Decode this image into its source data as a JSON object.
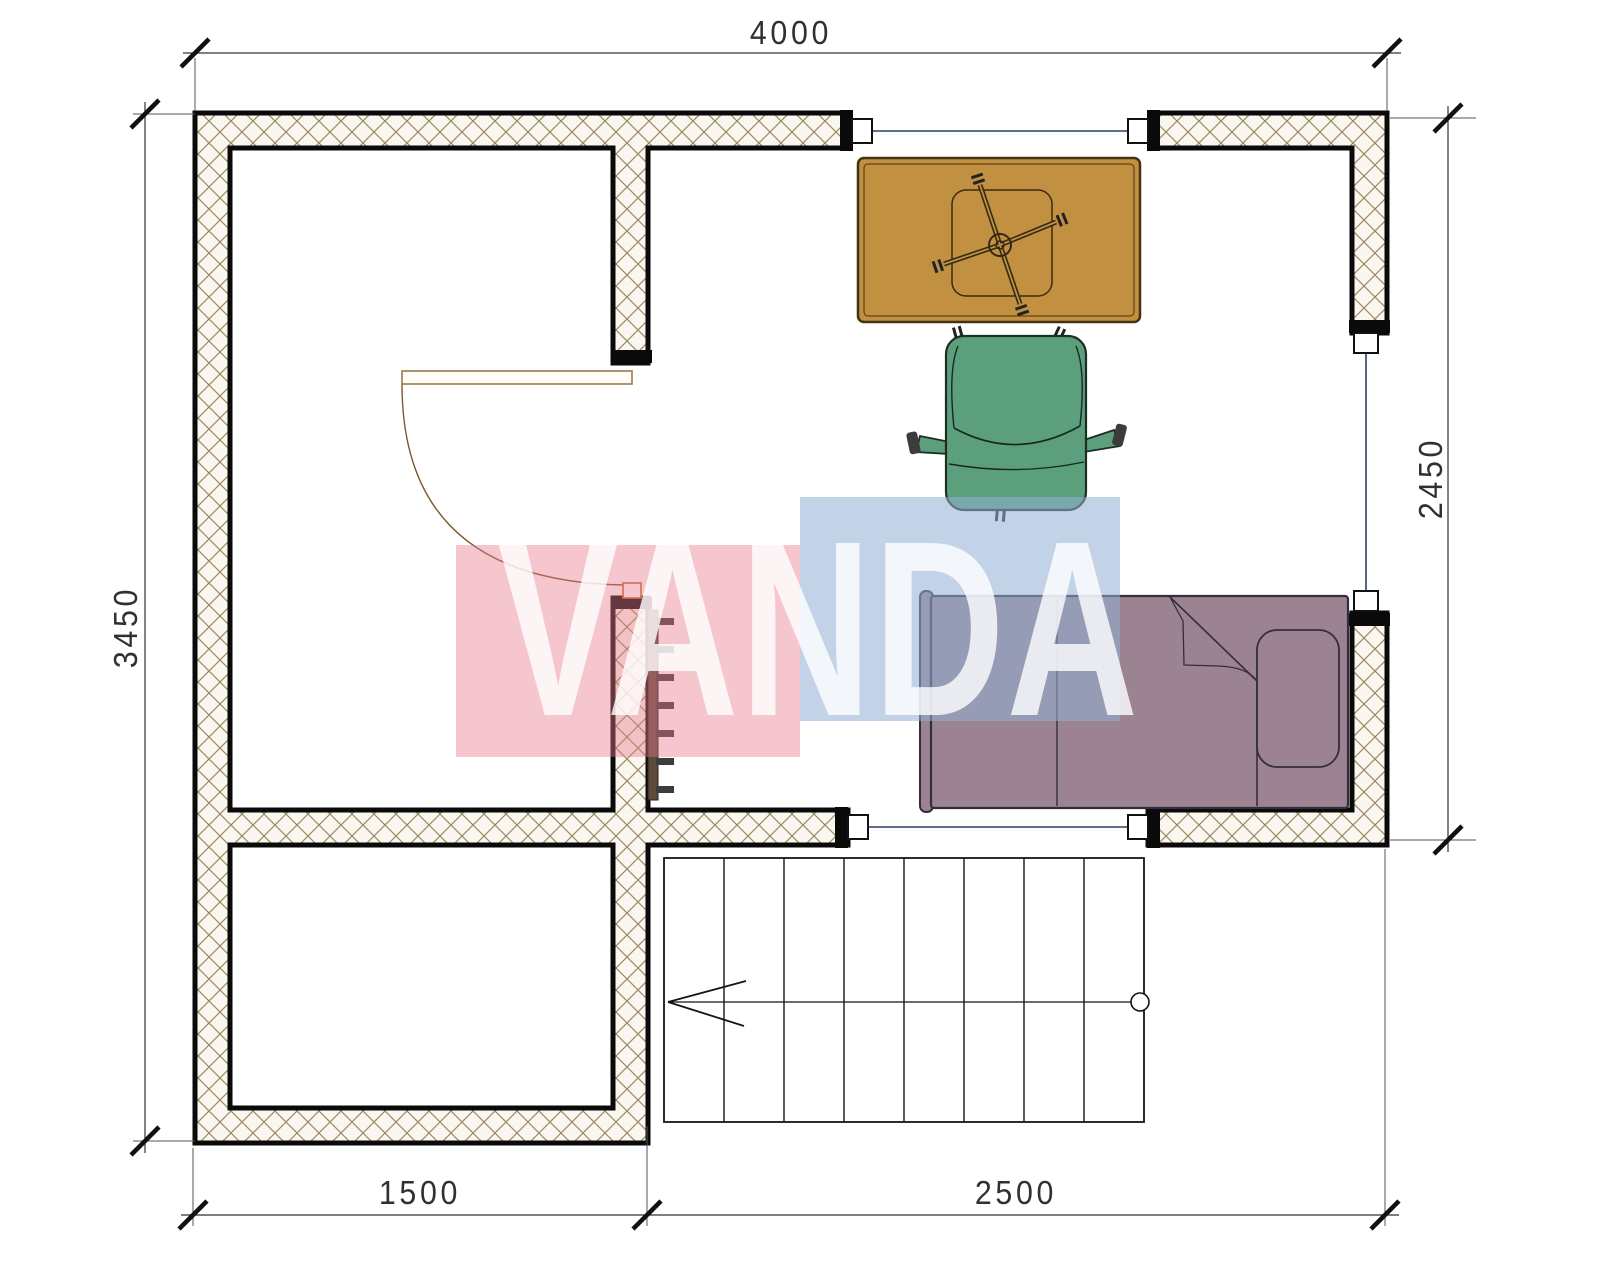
{
  "drawing": {
    "type": "floor-plan",
    "dimensions": {
      "top": "4000",
      "left": "3450",
      "right": "2450",
      "bottom_left": "1500",
      "bottom_right": "2500"
    },
    "watermark": {
      "text": "VANDA",
      "pink_block": "#f7c2c9",
      "blue_block": "#c5d5e8"
    },
    "colors": {
      "wall_fill": "#faf7f0",
      "wall_hatch": "#9a8a62",
      "wall_outline": "#0a0a0a",
      "window_line": "#2e3f68",
      "door": "#9a7a4a",
      "desk": "#c29041",
      "chair": "#5c9f7d",
      "bed": "#9c8392",
      "radiator": "#5d4a3d",
      "dimension_line": "#333333"
    },
    "elements": {
      "furniture": [
        "desk",
        "office-chair",
        "bed",
        "radiator"
      ],
      "windows": 3,
      "doors": 1,
      "stairs_treads": 8
    }
  }
}
